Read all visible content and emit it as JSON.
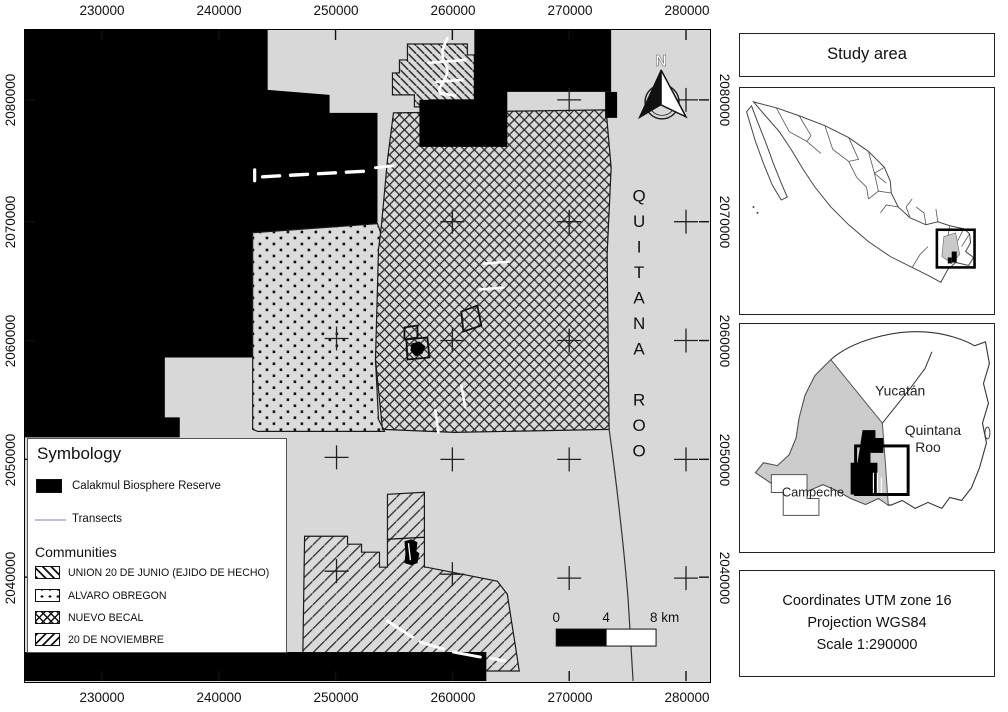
{
  "figure": {
    "land_color": "#d8d8d8",
    "reserve_color": "#000000",
    "map_transect_color": "#ffffff"
  },
  "axes": {
    "x_ticks": [
      "230000",
      "240000",
      "250000",
      "260000",
      "270000",
      "280000"
    ],
    "y_ticks": [
      "2080000",
      "2070000",
      "2060000",
      "2050000",
      "2040000"
    ]
  },
  "map": {
    "region_label": "QUITANA ROO",
    "north_label": "N",
    "scalebar": {
      "zero": "0",
      "mid": "4",
      "end": "8 km"
    }
  },
  "legend": {
    "title": "Symbology",
    "reserve_label": "Calakmul Biosphere Reserve",
    "transects_label": "Transects",
    "communities_title": "Communities",
    "communities": [
      "UNION 20 DE JUNIO (EJIDO DE HECHO)",
      "ALVARO OBREGON",
      "NUEVO BECAL",
      "20 DE NOVIEMBRE"
    ],
    "transect_swatch_color": "#c9bce4"
  },
  "side_panel": {
    "title": "Study area",
    "inset_labels": {
      "yucatan": "Yucatán",
      "quintana_line1": "Quintana",
      "quintana_line2": "Roo",
      "campeche": "Campeche"
    },
    "info_lines": [
      "Coordinates UTM zone 16",
      "Projection WGS84",
      "Scale 1:290000"
    ]
  }
}
